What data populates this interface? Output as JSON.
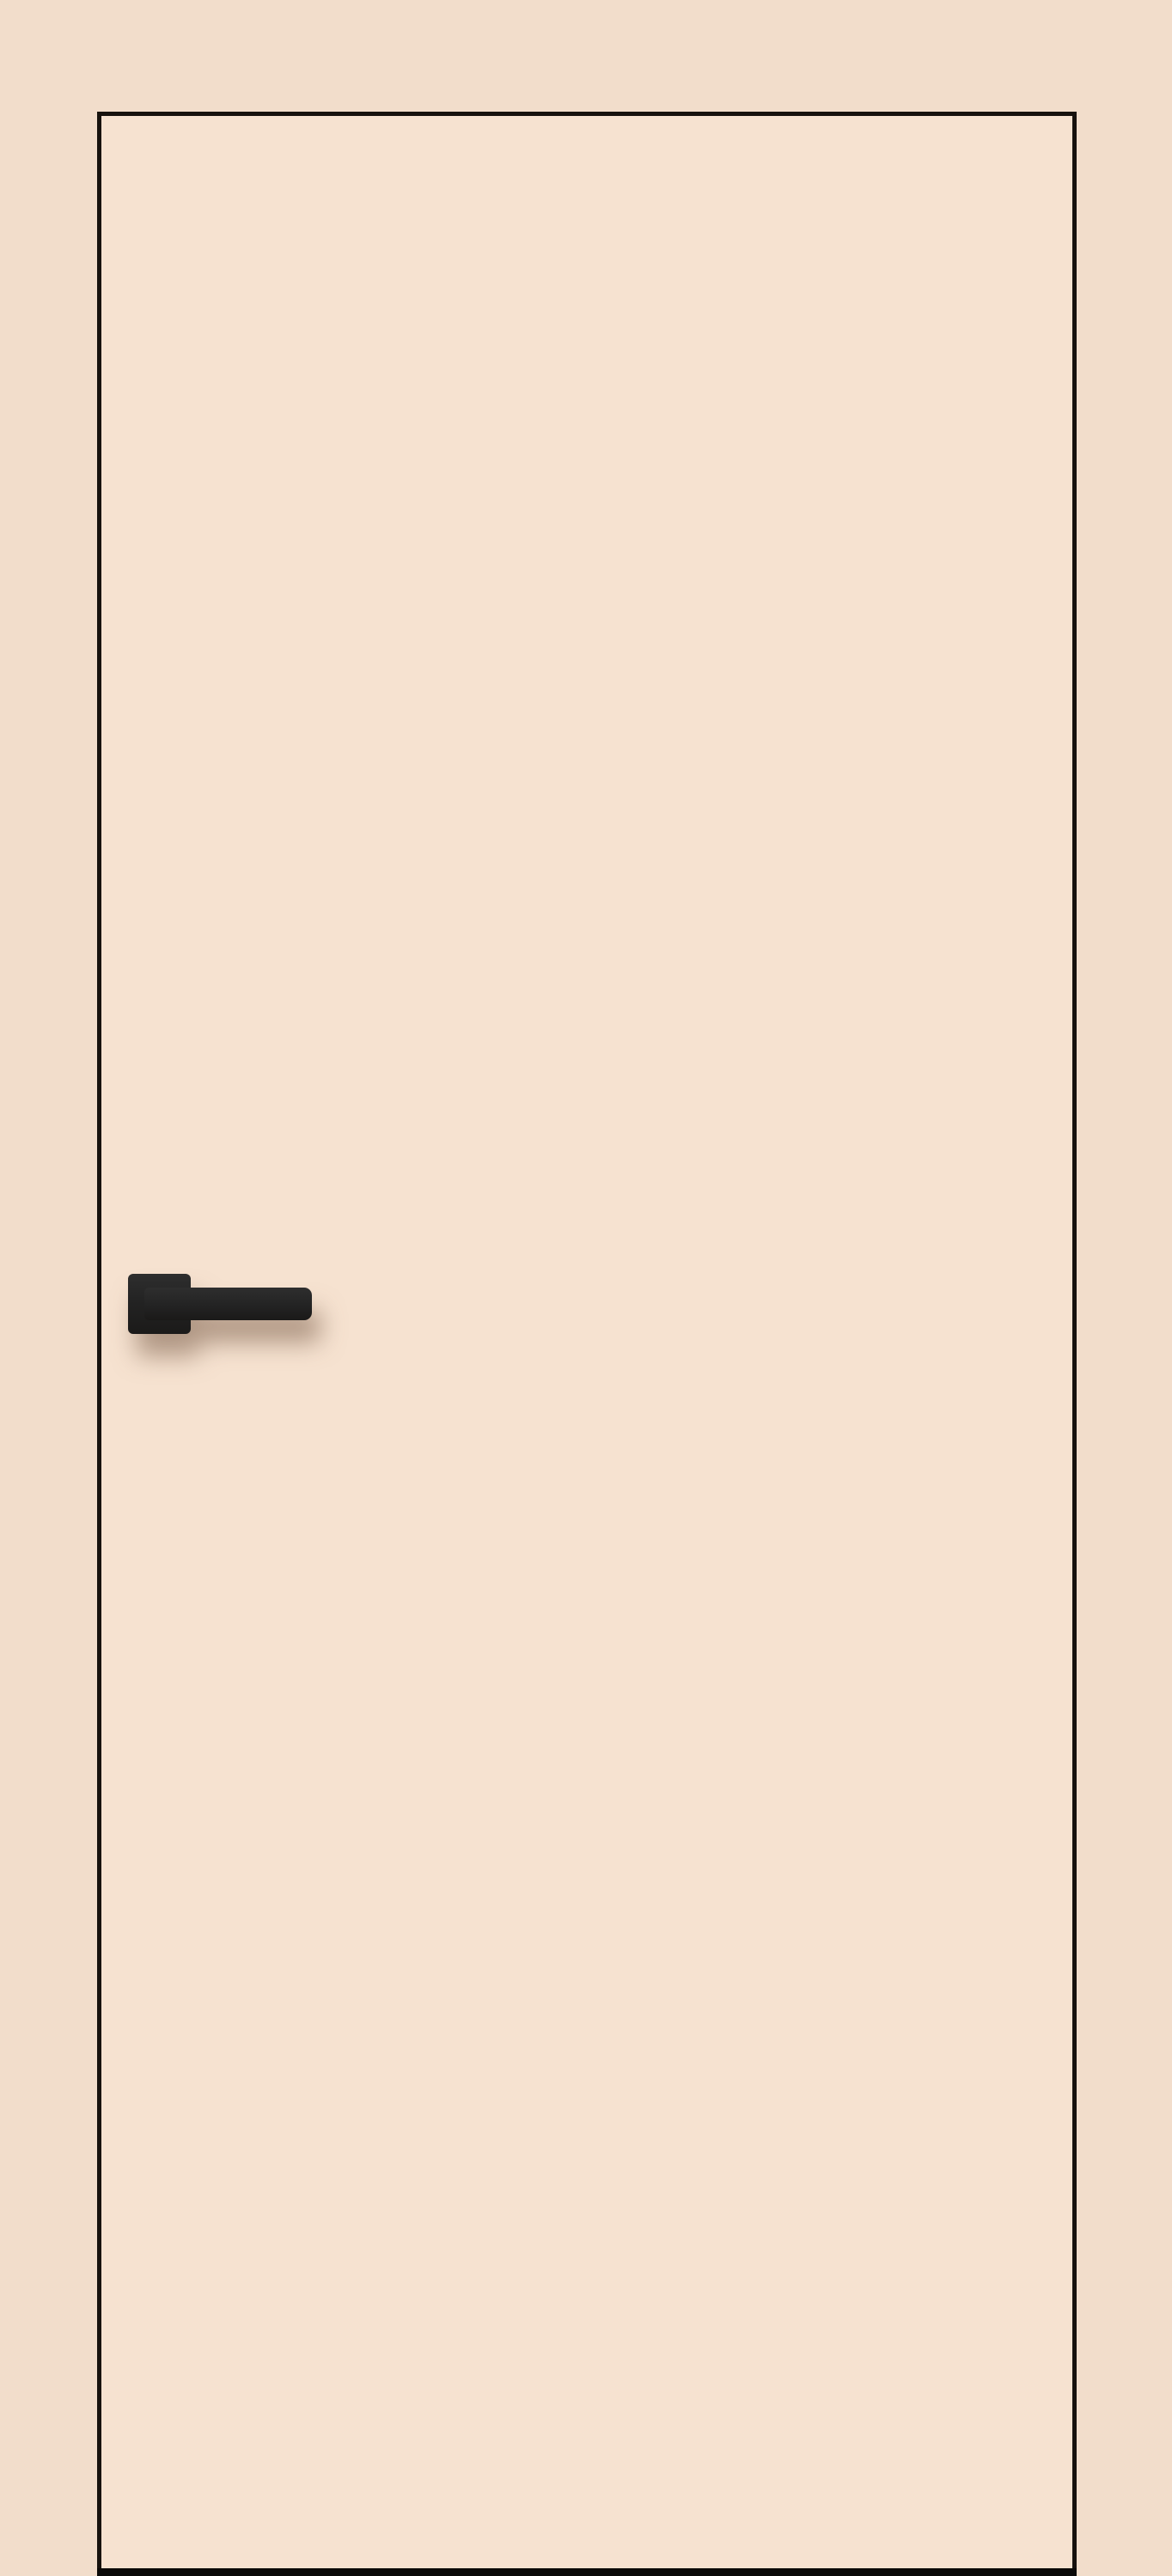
{
  "meta": {
    "description": "Front view product render of a closed flush interior door in a cream finish, flush with a cream wall, outlined by a thin dark edge line, with a black square-rosette lever handle on the left side and a dark gap beneath the door"
  },
  "colors": {
    "wall": "#f2ddcb",
    "door-surface": "#f6e2d0",
    "door-edge": "#17120e",
    "door-bottom-gap": "#0b0908",
    "handle": "#232323",
    "handle-highlight": "#2e2e2e",
    "handle-shadow": "rgba(108,78,58,0.5)"
  },
  "objects": {
    "wall": "plain cream wall",
    "door_panel": "flush cream door slab, no glazing, no moulding",
    "door_handle": "matte black lever handle on square rosette, pointing right",
    "door_bottom_gap": "dark threshold gap under door"
  }
}
